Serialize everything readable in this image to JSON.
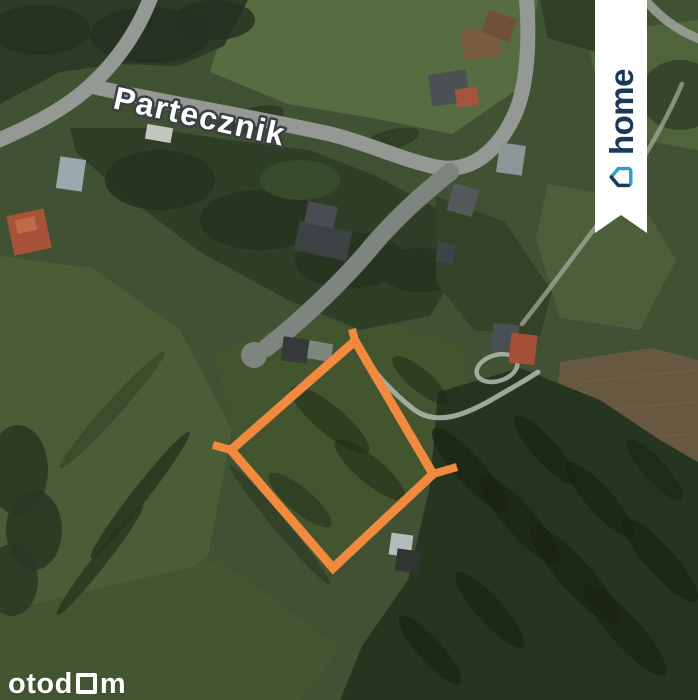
{
  "map": {
    "street_label": {
      "text": "Partecznik",
      "transform": "translate(112,108) rotate(12.5)"
    },
    "plot_outline": {
      "color": "#F18A3E",
      "stroke_width": 9,
      "points": "355,341 433,474 333,568 231,450",
      "boundary_stubs": [
        "M355,341 L352,329",
        "M231,450 L213,445",
        "M433,474 L457,467"
      ]
    },
    "palette": {
      "plot_outline_orange": "#F18A3E",
      "road_gray": "#949A93",
      "field_green": "#415234",
      "forest_green": "#2C3B25",
      "label_white": "#FFFFFF"
    },
    "layers": [
      {
        "name": "base",
        "items": [
          {
            "kind": "rect",
            "x": 0,
            "y": 0,
            "width": 698,
            "height": 700,
            "fill": "#415234"
          }
        ]
      },
      {
        "name": "fields",
        "items": [
          {
            "kind": "polygon",
            "points": "232,0 538,0 522,86 452,134 372,118 288,104 210,72",
            "fill": "#576C41"
          },
          {
            "kind": "polygon",
            "points": "586,34 698,20 698,150 640,140 600,96",
            "fill": "#50643C"
          },
          {
            "kind": "polygon",
            "points": "548,184 640,200 676,260 640,330 560,318 536,238",
            "fill": "#4C5F3A"
          },
          {
            "kind": "polygon",
            "points": "0,256 92,268 180,330 232,430 208,556 100,636 0,610",
            "fill": "#4B5D37"
          },
          {
            "kind": "polygon",
            "points": "214,352 332,306 462,344 470,420 432,470 332,570 240,468",
            "fill": "#43552F"
          },
          {
            "kind": "polygon",
            "points": "0,612 220,560 340,648 300,700 0,700",
            "fill": "#445631"
          },
          {
            "kind": "polygon",
            "points": "560,362 652,348 698,360 698,470 594,468 556,420",
            "fill": "#675841"
          },
          {
            "kind": "path",
            "d": "M580,382 L696,370",
            "stroke": "#75614A",
            "stroke-width": 2,
            "fill": "none",
            "opacity": 0.5
          },
          {
            "kind": "path",
            "d": "M574,412 L696,402",
            "stroke": "#75614A",
            "stroke-width": 2,
            "fill": "none",
            "opacity": 0.5
          },
          {
            "kind": "path",
            "d": "M582,442 L692,434",
            "stroke": "#75614A",
            "stroke-width": 2,
            "fill": "none",
            "opacity": 0.5
          }
        ]
      },
      {
        "name": "forests",
        "items": [
          {
            "kind": "polygon",
            "points": "0,0 248,0 224,46 178,66 118,64 60,72 0,104",
            "fill": "#2C3B25"
          },
          {
            "kind": "ellipse",
            "cx": 40,
            "cy": 30,
            "rx": 50,
            "ry": 25,
            "fill": "#243120",
            "opacity": 0.85
          },
          {
            "kind": "ellipse",
            "cx": 150,
            "cy": 35,
            "rx": 60,
            "ry": 28,
            "fill": "#243120",
            "opacity": 0.8
          },
          {
            "kind": "ellipse",
            "cx": 215,
            "cy": 20,
            "rx": 40,
            "ry": 20,
            "fill": "#243120",
            "opacity": 0.8
          },
          {
            "kind": "polygon",
            "points": "70,128 150,128 230,140 310,150 376,176 440,210 462,262 430,316 360,330 288,300 200,252 118,190 76,152",
            "fill": "#2E3E27"
          },
          {
            "kind": "ellipse",
            "cx": 160,
            "cy": 180,
            "rx": 55,
            "ry": 30,
            "fill": "#26331F",
            "opacity": 0.85
          },
          {
            "kind": "ellipse",
            "cx": 260,
            "cy": 220,
            "rx": 60,
            "ry": 30,
            "fill": "#26331F",
            "opacity": 0.85
          },
          {
            "kind": "ellipse",
            "cx": 350,
            "cy": 260,
            "rx": 55,
            "ry": 28,
            "fill": "#26331F",
            "opacity": 0.85
          },
          {
            "kind": "ellipse",
            "cx": 420,
            "cy": 270,
            "rx": 40,
            "ry": 22,
            "fill": "#26331F",
            "opacity": 0.8
          },
          {
            "kind": "ellipse",
            "cx": 300,
            "cy": 180,
            "rx": 40,
            "ry": 20,
            "fill": "#3A4C2E",
            "opacity": 0.9
          },
          {
            "kind": "polygon",
            "points": "436,196 505,222 552,292 540,336 474,330 436,282",
            "fill": "#324329"
          },
          {
            "kind": "polygon",
            "points": "438,392 520,368 600,400 660,440 698,462 698,700 340,700 362,646 408,580 430,486",
            "fill": "#263520"
          },
          {
            "kind": "polygon",
            "points": "540,0 608,0 596,52 548,38",
            "fill": "#2F3F28"
          },
          {
            "kind": "ellipse",
            "cx": 680,
            "cy": 95,
            "rx": 40,
            "ry": 35,
            "fill": "#33432A",
            "opacity": 0.9
          },
          {
            "kind": "ellipse",
            "cx": 18,
            "cy": 470,
            "rx": 30,
            "ry": 45,
            "fill": "#2A3823",
            "opacity": 0.9
          },
          {
            "kind": "ellipse",
            "cx": 34,
            "cy": 530,
            "rx": 28,
            "ry": 40,
            "fill": "#2A3823",
            "opacity": 0.9
          },
          {
            "kind": "ellipse",
            "cx": 12,
            "cy": 580,
            "rx": 26,
            "ry": 36,
            "fill": "#2A3823",
            "opacity": 0.85
          }
        ]
      },
      {
        "name": "shadows",
        "items": [
          {
            "kind": "ellipse",
            "cx": 140,
            "cy": 495,
            "rx": 80,
            "ry": 8,
            "rot": -52,
            "fill": "#26331D",
            "opacity": 0.8
          },
          {
            "kind": "ellipse",
            "cx": 100,
            "cy": 560,
            "rx": 70,
            "ry": 7,
            "rot": -52,
            "fill": "#26331D",
            "opacity": 0.75
          },
          {
            "kind": "ellipse",
            "cx": 280,
            "cy": 525,
            "rx": 78,
            "ry": 7,
            "rot": 50,
            "fill": "#2D3B24",
            "opacity": 0.7
          },
          {
            "kind": "ellipse",
            "cx": 112,
            "cy": 410,
            "rx": 78,
            "ry": 8,
            "rot": -48,
            "fill": "#2D3B24",
            "opacity": 0.5
          },
          {
            "kind": "ellipse",
            "cx": 250,
            "cy": 120,
            "rx": 35,
            "ry": 12,
            "rot": -15,
            "fill": "#1C2714",
            "opacity": 0.5
          },
          {
            "kind": "ellipse",
            "cx": 390,
            "cy": 140,
            "rx": 30,
            "ry": 10,
            "rot": -15,
            "fill": "#1C2714",
            "opacity": 0.45
          },
          {
            "kind": "ellipse",
            "cx": 330,
            "cy": 420,
            "rx": 50,
            "ry": 14,
            "rot": 40,
            "fill": "#1C2714",
            "opacity": 0.5
          },
          {
            "kind": "ellipse",
            "cx": 370,
            "cy": 470,
            "rx": 45,
            "ry": 13,
            "rot": 40,
            "fill": "#1C2714",
            "opacity": 0.5
          },
          {
            "kind": "ellipse",
            "cx": 300,
            "cy": 500,
            "rx": 40,
            "ry": 12,
            "rot": 40,
            "fill": "#1C2714",
            "opacity": 0.45
          },
          {
            "kind": "ellipse",
            "cx": 420,
            "cy": 380,
            "rx": 35,
            "ry": 11,
            "rot": 40,
            "fill": "#1C2714",
            "opacity": 0.5
          },
          {
            "kind": "ellipse",
            "cx": 470,
            "cy": 470,
            "rx": 55,
            "ry": 14,
            "rot": 48,
            "fill": "#18220F",
            "opacity": 0.65
          },
          {
            "kind": "ellipse",
            "cx": 520,
            "cy": 520,
            "rx": 60,
            "ry": 15,
            "rot": 48,
            "fill": "#18220F",
            "opacity": 0.65
          },
          {
            "kind": "ellipse",
            "cx": 575,
            "cy": 575,
            "rx": 65,
            "ry": 16,
            "rot": 48,
            "fill": "#18220F",
            "opacity": 0.65
          },
          {
            "kind": "ellipse",
            "cx": 625,
            "cy": 630,
            "rx": 60,
            "ry": 15,
            "rot": 48,
            "fill": "#18220F",
            "opacity": 0.65
          },
          {
            "kind": "ellipse",
            "cx": 545,
            "cy": 450,
            "rx": 45,
            "ry": 12,
            "rot": 48,
            "fill": "#18220F",
            "opacity": 0.6
          },
          {
            "kind": "ellipse",
            "cx": 600,
            "cy": 500,
            "rx": 50,
            "ry": 13,
            "rot": 48,
            "fill": "#18220F",
            "opacity": 0.6
          },
          {
            "kind": "ellipse",
            "cx": 660,
            "cy": 560,
            "rx": 55,
            "ry": 14,
            "rot": 48,
            "fill": "#18220F",
            "opacity": 0.6
          },
          {
            "kind": "ellipse",
            "cx": 490,
            "cy": 610,
            "rx": 50,
            "ry": 13,
            "rot": 48,
            "fill": "#18220F",
            "opacity": 0.6
          },
          {
            "kind": "ellipse",
            "cx": 430,
            "cy": 650,
            "rx": 45,
            "ry": 12,
            "rot": 48,
            "fill": "#18220F",
            "opacity": 0.6
          },
          {
            "kind": "ellipse",
            "cx": 655,
            "cy": 470,
            "rx": 40,
            "ry": 11,
            "rot": 48,
            "fill": "#18220F",
            "opacity": 0.55
          }
        ]
      },
      {
        "name": "roads",
        "items": [
          {
            "kind": "path",
            "d": "M152,-6 C138,32 116,62 90,86 C64,110 28,128 -6,142",
            "stroke": "#949A93",
            "stroke-width": 15,
            "fill": "none",
            "stroke-linecap": "round"
          },
          {
            "kind": "path",
            "d": "M90,86 C160,102 250,116 330,134 C368,143 402,160 436,167 C472,174 498,150 514,116 C528,86 530,38 526,-6",
            "stroke": "#949A93",
            "stroke-width": 15,
            "fill": "none",
            "stroke-linecap": "round"
          },
          {
            "kind": "path",
            "d": "M642,-4 C658,16 676,30 702,40",
            "stroke": "#9AA094",
            "stroke-width": 9,
            "fill": "none",
            "opacity": 0.9,
            "stroke-linecap": "round"
          },
          {
            "kind": "path",
            "d": "M450,172 C420,196 396,218 372,246 C344,280 302,320 266,348",
            "stroke": "#7E857F",
            "stroke-width": 18,
            "fill": "none",
            "stroke-linecap": "round"
          },
          {
            "kind": "circle",
            "cx": 254,
            "cy": 355,
            "r": 13,
            "fill": "#7E857F"
          },
          {
            "kind": "rect",
            "x": 306,
            "y": 342,
            "width": 26,
            "height": 18,
            "rot": 10,
            "fill": "#8D948E",
            "opacity": 0.8
          }
        ]
      },
      {
        "name": "trails",
        "items": [
          {
            "kind": "path",
            "d": "M356,346 C372,370 392,392 412,408 C436,428 468,414 498,396 C512,388 526,380 538,372",
            "stroke": "#B5BAB0",
            "stroke-width": 5,
            "fill": "none",
            "opacity": 0.85,
            "stroke-linecap": "round"
          },
          {
            "kind": "path",
            "d": "M682,84 C662,130 632,180 598,224 C572,258 546,294 522,324",
            "stroke": "#A9AF9F",
            "stroke-width": 4.5,
            "fill": "none",
            "opacity": 0.7,
            "stroke-linecap": "round"
          },
          {
            "kind": "ellipse",
            "cx": 497,
            "cy": 368,
            "rx": 21,
            "ry": 13,
            "rot": -18,
            "fill": "none",
            "stroke": "#B5BAB0",
            "stroke-width": 4.5,
            "opacity": 0.85
          }
        ]
      },
      {
        "name": "buildings",
        "items": [
          {
            "kind": "rect",
            "x": 10,
            "y": 212,
            "width": 38,
            "height": 40,
            "rot": -12,
            "fill": "#A85238"
          },
          {
            "kind": "rect",
            "x": 16,
            "y": 218,
            "width": 20,
            "height": 14,
            "rot": -12,
            "fill": "#C06A48"
          },
          {
            "kind": "rect",
            "x": 58,
            "y": 158,
            "width": 26,
            "height": 32,
            "rot": 8,
            "fill": "#9AA8B0"
          },
          {
            "kind": "rect",
            "x": 146,
            "y": 126,
            "width": 26,
            "height": 15,
            "rot": 10,
            "fill": "#C2C8C0"
          },
          {
            "kind": "rect",
            "x": 296,
            "y": 226,
            "width": 54,
            "height": 30,
            "rot": 12,
            "fill": "#3C4144"
          },
          {
            "kind": "rect",
            "x": 306,
            "y": 204,
            "width": 30,
            "height": 22,
            "rot": 12,
            "fill": "#474D50"
          },
          {
            "kind": "rect",
            "x": 437,
            "y": 243,
            "width": 17,
            "height": 20,
            "rot": 10,
            "fill": "#3E4346"
          },
          {
            "kind": "rect",
            "x": 450,
            "y": 186,
            "width": 26,
            "height": 28,
            "rot": 16,
            "fill": "#545A5C"
          },
          {
            "kind": "rect",
            "x": 498,
            "y": 144,
            "width": 26,
            "height": 30,
            "rot": 8,
            "fill": "#8E9597"
          },
          {
            "kind": "rect",
            "x": 430,
            "y": 72,
            "width": 38,
            "height": 32,
            "rot": -8,
            "fill": "#4B5153"
          },
          {
            "kind": "rect",
            "x": 456,
            "y": 88,
            "width": 22,
            "height": 18,
            "rot": -8,
            "fill": "#A3553F"
          },
          {
            "kind": "rect",
            "x": 462,
            "y": 28,
            "width": 38,
            "height": 30,
            "rot": -6,
            "fill": "#7B5C3E"
          },
          {
            "kind": "rect",
            "x": 484,
            "y": 14,
            "width": 30,
            "height": 24,
            "rot": 20,
            "fill": "#6E5136"
          },
          {
            "kind": "rect",
            "x": 492,
            "y": 324,
            "width": 26,
            "height": 28,
            "rot": 6,
            "fill": "#4A4F52"
          },
          {
            "kind": "rect",
            "x": 510,
            "y": 334,
            "width": 26,
            "height": 30,
            "rot": 6,
            "fill": "#A44F36"
          },
          {
            "kind": "rect",
            "x": 390,
            "y": 534,
            "width": 22,
            "height": 22,
            "rot": 8,
            "fill": "#B6BCBE"
          },
          {
            "kind": "rect",
            "x": 396,
            "y": 550,
            "width": 24,
            "height": 22,
            "rot": 8,
            "fill": "#2F3531"
          },
          {
            "kind": "rect",
            "x": 282,
            "y": 338,
            "width": 26,
            "height": 24,
            "rot": 8,
            "fill": "#35393B"
          }
        ]
      }
    ]
  },
  "watermark": {
    "brand": "otodom",
    "part1": "otod",
    "part2": "m",
    "color": "#FFFFFF"
  },
  "ribbon": {
    "logo_text": "home",
    "text_color": "#1A3A5B",
    "icon_color_primary": "#1A3A5B",
    "icon_color_accent": "#2F9FD6",
    "background": "#FFFFFF"
  }
}
